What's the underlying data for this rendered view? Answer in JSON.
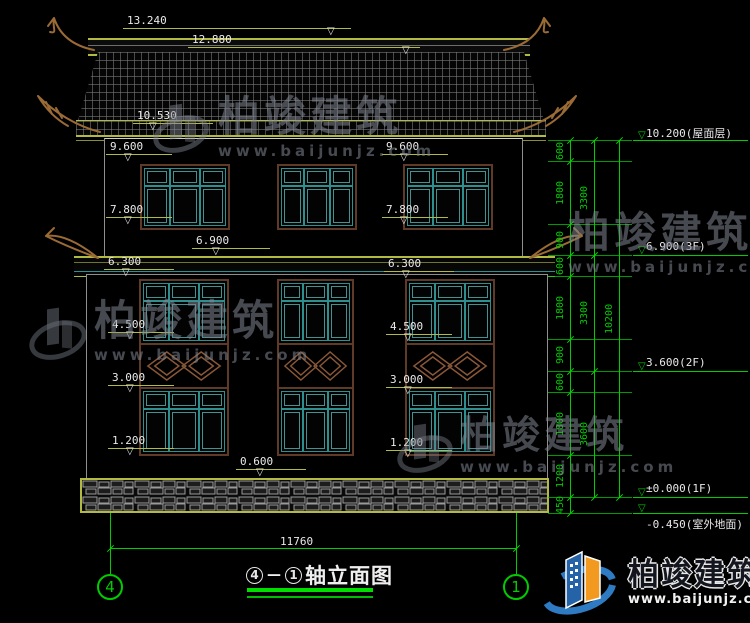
{
  "watermark": {
    "name": "柏竣建筑",
    "url": "www.baijunjz.com"
  },
  "footer": {
    "name": "柏竣建筑",
    "url": "www.baijunjz.com"
  },
  "title": {
    "axis_start": "4",
    "dash": "—",
    "axis_end": "1",
    "text": "轴立面图"
  },
  "axes": [
    {
      "label": "4",
      "x": 97
    },
    {
      "label": "1",
      "x": 503
    }
  ],
  "bottom_dim": {
    "label": "11760"
  },
  "left_markers": [
    {
      "label": "13.240",
      "x": 127,
      "y": 14,
      "lw": 228,
      "tx": 200
    },
    {
      "label": "12.880",
      "x": 192,
      "y": 33,
      "lw": 232,
      "tx": 210
    },
    {
      "label": "10.530",
      "x": 137,
      "y": 109,
      "lw": 80,
      "tx": 12
    },
    {
      "label": "9.600",
      "x": 110,
      "y": 140,
      "lw": 66,
      "tx": 14
    },
    {
      "label": "9.600",
      "x": 386,
      "y": 140,
      "lw": 66,
      "tx": 14
    },
    {
      "label": "7.800",
      "x": 110,
      "y": 203,
      "lw": 66,
      "tx": 14
    },
    {
      "label": "7.800",
      "x": 386,
      "y": 203,
      "lw": 66,
      "tx": 14
    },
    {
      "label": "6.900",
      "x": 196,
      "y": 234,
      "lw": 78,
      "tx": 16
    },
    {
      "label": "6.300",
      "x": 108,
      "y": 255,
      "lw": 70,
      "tx": 14
    },
    {
      "label": "6.300",
      "x": 388,
      "y": 257,
      "lw": 70,
      "tx": 14
    },
    {
      "label": "4.500",
      "x": 112,
      "y": 318,
      "lw": 66,
      "tx": 14
    },
    {
      "label": "4.500",
      "x": 390,
      "y": 320,
      "lw": 66,
      "tx": 14
    },
    {
      "label": "3.000",
      "x": 112,
      "y": 371,
      "lw": 66,
      "tx": 14
    },
    {
      "label": "3.000",
      "x": 390,
      "y": 373,
      "lw": 66,
      "tx": 14
    },
    {
      "label": "1.200",
      "x": 112,
      "y": 434,
      "lw": 66,
      "tx": 14
    },
    {
      "label": "1.200",
      "x": 390,
      "y": 436,
      "lw": 66,
      "tx": 14
    },
    {
      "label": "0.600",
      "x": 240,
      "y": 455,
      "lw": 70,
      "tx": 16
    }
  ],
  "right_levels": [
    {
      "label": "10.200(屋面层)",
      "y": 140,
      "below": false
    },
    {
      "label": "6.900(3F)",
      "y": 255,
      "below": false
    },
    {
      "label": "3.600(2F)",
      "y": 371,
      "below": false
    },
    {
      "label": "±0.000(1F)",
      "y": 497,
      "below": false
    },
    {
      "label": "-0.450(室外地面)",
      "y": 513,
      "below": true
    }
  ],
  "chains": [
    {
      "x": 570,
      "ticks": [
        140,
        161,
        224,
        255,
        276,
        339,
        371,
        392,
        455,
        497,
        513
      ],
      "labels": [
        "600",
        "1800",
        "900",
        "600",
        "1800",
        "900",
        "600",
        "1800",
        "1200",
        "450"
      ]
    },
    {
      "x": 594,
      "ticks": [
        140,
        255,
        371,
        497
      ],
      "labels": [
        "3300",
        "3300",
        "3600"
      ]
    },
    {
      "x": 619,
      "ticks": [
        140,
        497
      ],
      "labels": [
        "10200"
      ]
    }
  ]
}
